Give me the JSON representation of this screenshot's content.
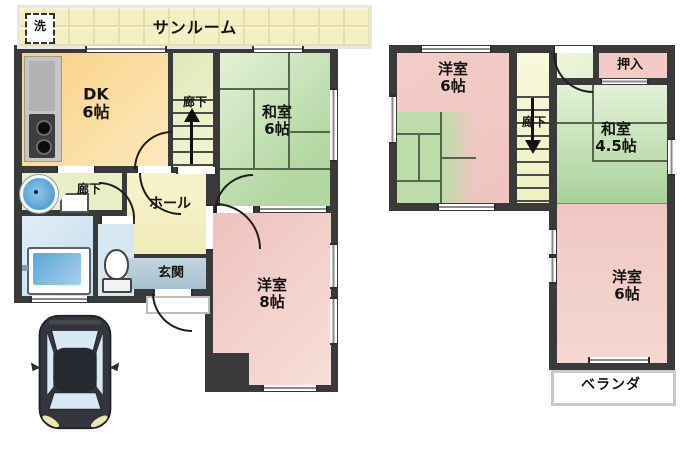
{
  "plan_title": "2-story house floor plan",
  "floor1": {
    "sunroom_label": "サンルーム",
    "washer_label": "洗",
    "dk": {
      "name": "DK",
      "size": "6帖"
    },
    "stair_corridor_label": "廊下",
    "washitsu": {
      "name": "和室",
      "size": "6帖"
    },
    "hall_label": "ホール",
    "corridor_label": "廊下",
    "genkan_label": "玄関",
    "yoshitsu8": {
      "name": "洋室",
      "size": "8帖"
    }
  },
  "floor2": {
    "yoshitsu6_upper": {
      "name": "洋室",
      "size": "6帖"
    },
    "stair_corridor_label": "廊下",
    "oshiire_label": "押入",
    "washitsu45": {
      "name": "和室",
      "size": "4.5帖"
    },
    "yoshitsu6_lower": {
      "name": "洋室",
      "size": "6帖"
    },
    "veranda_label": "ベランダ"
  },
  "colors": {
    "wall": "#3a3a3a",
    "dk_fill": "#fbd68d",
    "tatami_green": "#b4d8a4",
    "western_pink": "#f0c5c0",
    "hall_cream": "#f6f0c6",
    "stairs_yellow": "#eef2c4",
    "genkan_blue_grey": "#b6cbd8",
    "bath_blue": "#cfe4f2",
    "sunroom_tile": "#f5efc3",
    "car_body": "#32353b",
    "car_glass": "#d8e8f5"
  }
}
